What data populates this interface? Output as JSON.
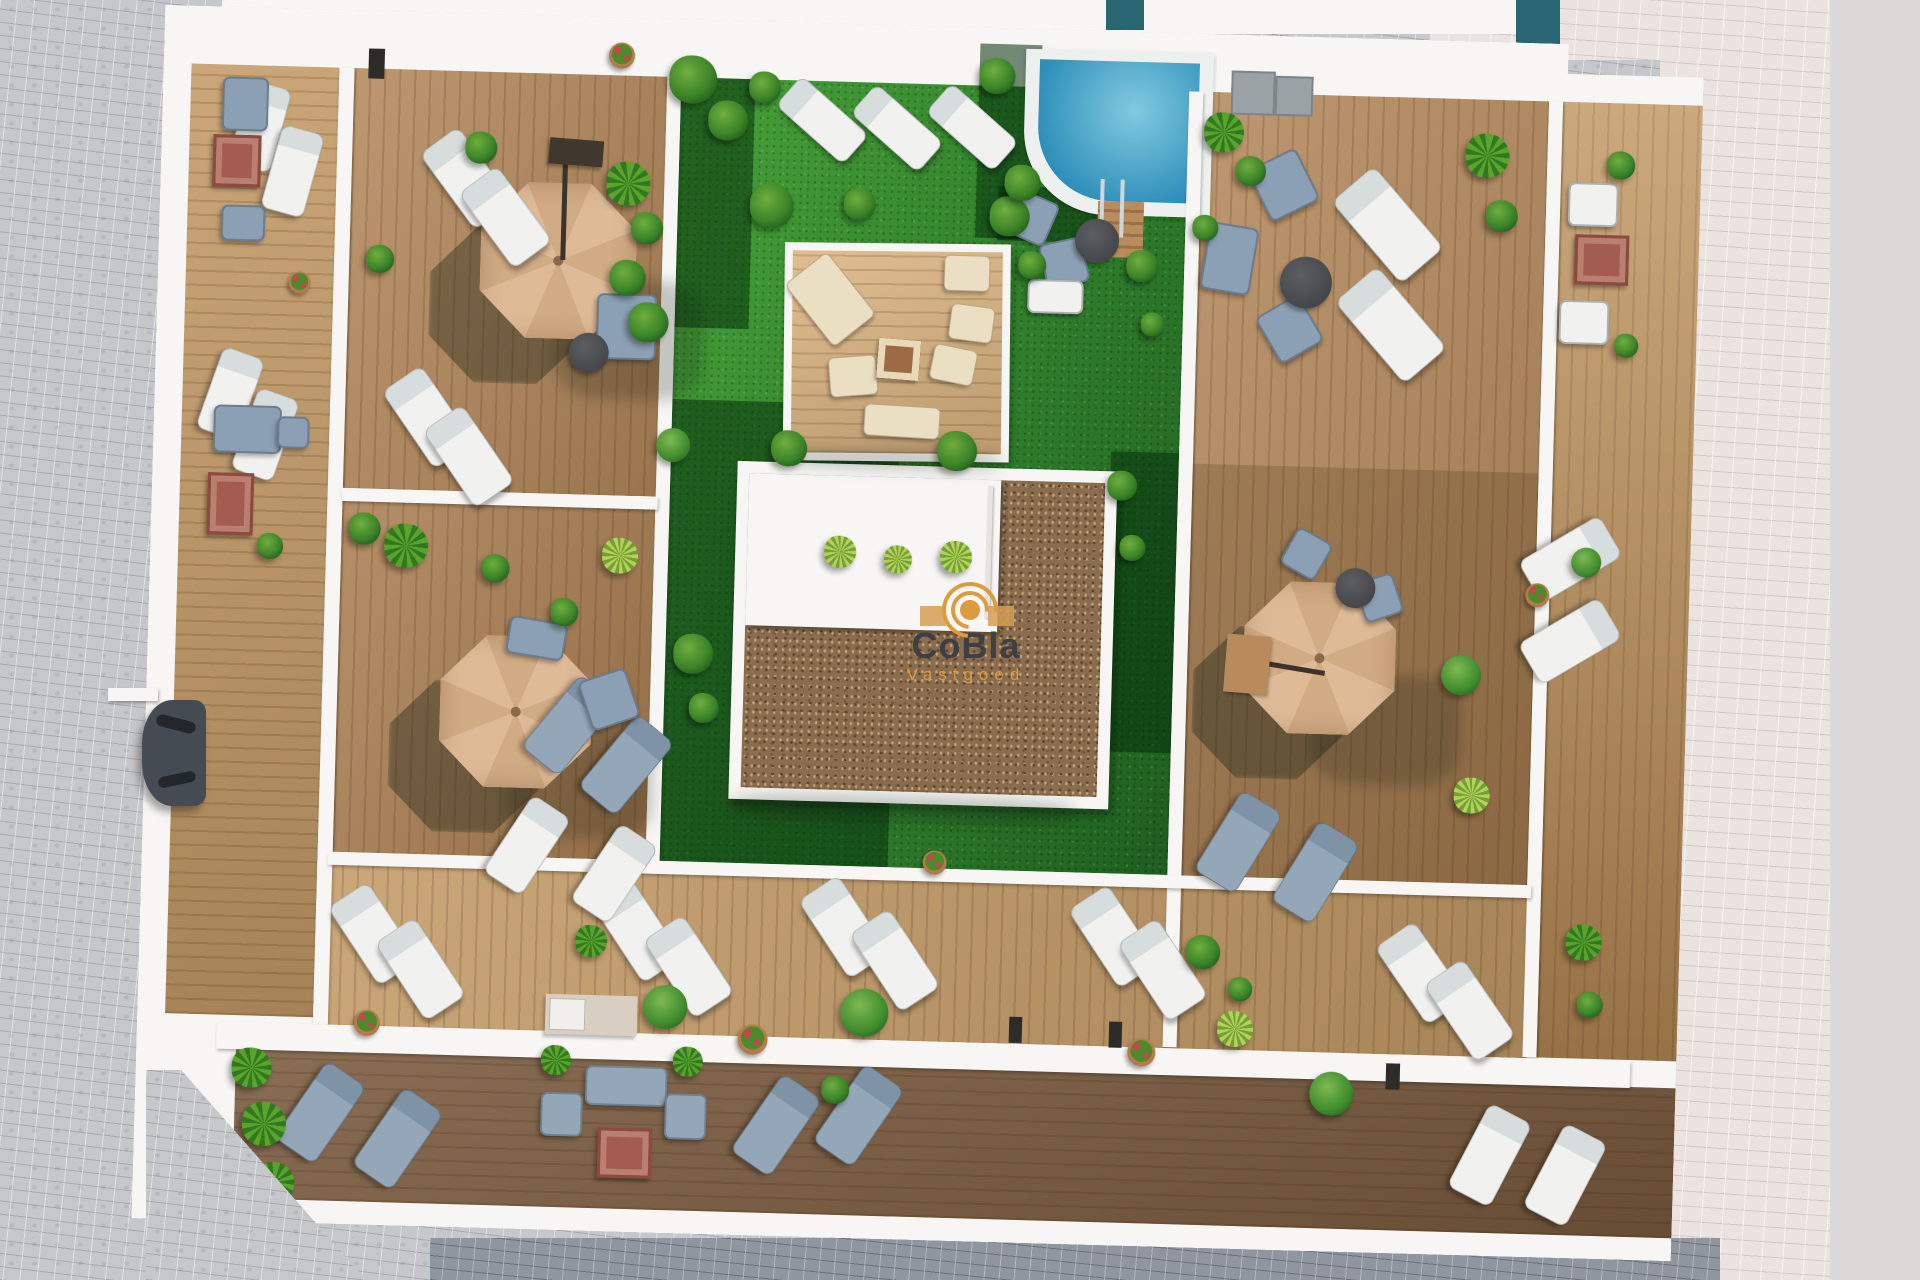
{
  "scene": {
    "type": "aerial-3d-architectural-render",
    "subject": "Top-down rooftop terrace plan of an apartment building",
    "features": [
      "wood deck terraces",
      "central lawn courtyard",
      "swimming pool",
      "roof core with gravel",
      "pergola lounge deck",
      "parasols",
      "sun loungers",
      "outdoor sofas",
      "fire tables",
      "planters and palms",
      "paved streets",
      "parked car"
    ]
  },
  "watermark": {
    "brand": "CoBla",
    "subtitle": "Vastgoed"
  },
  "palette": {
    "roof_white": "#f7f6f4",
    "wood_light": "#c39a66",
    "wood_mid": "#b3885a",
    "wood_mid2": "#aa7f52",
    "wood_dark": "#795a3d",
    "wood_pergola": "#dcb582",
    "grass_bright": "#47a238",
    "pool_light": "#82cadf",
    "pool_deep": "#2e8fba",
    "gravel": "#8a6c4e",
    "umbrella_tan": "#d9b48f",
    "furniture_white": "#f1f2f0",
    "furniture_gray": "#93a7b8",
    "furniture_blue": "#8ba0b4",
    "fire_table_red": "#a55c50",
    "table_dark": "#45474a",
    "car_gray": "#454b52",
    "wm_text": "#3f3e42",
    "wm_accent": "#dd9b3f"
  }
}
